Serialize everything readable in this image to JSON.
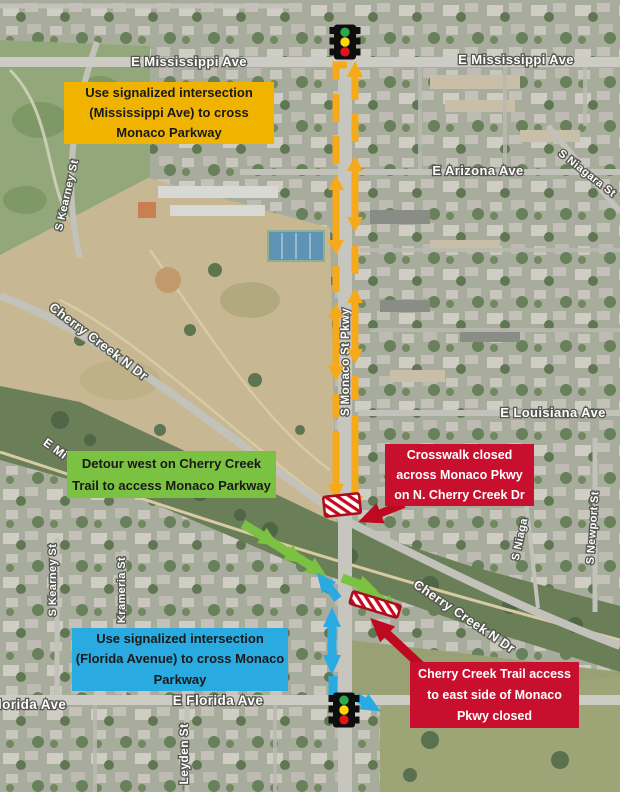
{
  "streets": {
    "mississippi_left": "E Mississippi Ave",
    "mississippi_right": "E Mississippi Ave",
    "mississippi_partial": "E Mi",
    "arizona": "E Arizona Ave",
    "niagara": "S Niagara St",
    "niagara_partial": "S Niaga",
    "kearney_north": "S Kearney St",
    "kearney_south": "S Kearney St",
    "cherry_creek_upper": "Cherry Creek N Dr",
    "cherry_creek_lower": "Cherry Creek N Dr",
    "monaco": "S Monaco St Pkwy",
    "louisiana": "E Louisiana Ave",
    "newport": "S Newport St",
    "krameria": "Krameria St",
    "leyden": "Leyden St",
    "florida_center": "E Florida Ave",
    "florida_partial": "lorida Ave"
  },
  "callouts": {
    "mississippi": {
      "lines": [
        "Use signalized intersection",
        "(Mississippi Ave) to cross",
        "Monaco Parkway"
      ]
    },
    "detour": {
      "lines": [
        "Detour west on Cherry Creek",
        "Trail to access Monaco Parkway"
      ]
    },
    "crosswalk_closed": {
      "lines": [
        "Crosswalk closed",
        "across Monaco Pkwy",
        "on N. Cherry Creek Dr"
      ]
    },
    "florida": {
      "lines": [
        "Use signalized intersection",
        "(Florida Avenue) to cross Monaco",
        "Parkway"
      ]
    },
    "trail_access": {
      "lines": [
        "Cherry Creek Trail access",
        "to east side of Monaco",
        "Pkwy closed"
      ]
    }
  },
  "icons": {
    "traffic_light_top": "traffic-light",
    "traffic_light_bottom": "traffic-light",
    "crosswalk_closure": "red-white-hatched-closure",
    "trail_closure": "red-white-hatched-closure"
  },
  "colors": {
    "box_yellow": "#F0B400",
    "arrow_yellow": "#F7A91C",
    "box_green": "#7CC242",
    "arrow_green": "#7CC242",
    "box_blue": "#29ABE2",
    "arrow_blue": "#29ABE2",
    "box_red": "#C8102E",
    "arrow_red": "#BE0A1E",
    "hatch_red": "#C9081F",
    "traffic_green": "#2BA84A",
    "traffic_yellow": "#FFD60A",
    "traffic_red": "#E3111B"
  }
}
